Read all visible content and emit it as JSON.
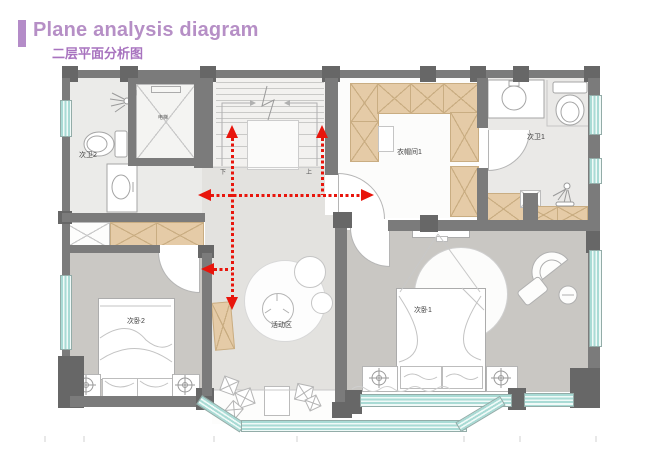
{
  "header": {
    "title_en": "Plane analysis diagram",
    "title_zh": "二层平面分析图"
  },
  "rooms": {
    "bath2": "次卫2",
    "bath1": "次卫1",
    "closet1": "衣帽间1",
    "bedroom2": "次卧2",
    "bedroom1": "次卧1",
    "activity": "活动区",
    "elevator": "电梯",
    "stair_down": "下",
    "stair_up": "上"
  },
  "colors": {
    "accent_purple": "#b48cc8",
    "subtitle_purple": "#a873bf",
    "arrow_red": "#e8150c",
    "wall_gray": "#7b7b7b",
    "wall_dark": "#676767",
    "cabinet_tan": "#e5cba7",
    "window_teal": "#a9dbd5",
    "floor_bedroom": "#cac8c4",
    "floor_hall": "#e3e2df"
  }
}
